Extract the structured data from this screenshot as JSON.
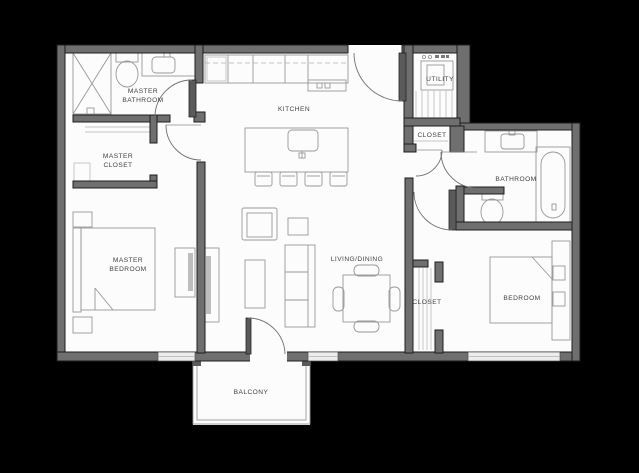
{
  "title": "two-bedroom-apartment-floor-plan",
  "colors": {
    "background": "#000000",
    "floor": "#fcfcfc",
    "wall_fill": "#6f6f6f",
    "wall_edge": "#1e1e1e",
    "furniture_line": "#989898",
    "window_fill": "#ededed",
    "label_text": "#3f3f3f"
  },
  "rooms": [
    {
      "id": "master-bathroom",
      "label_line1": "MASTER",
      "label_line2": "BATHROOM"
    },
    {
      "id": "master-closet",
      "label_line1": "MASTER",
      "label_line2": "CLOSET"
    },
    {
      "id": "kitchen",
      "label": "KITCHEN"
    },
    {
      "id": "utility",
      "label": "UTILITY"
    },
    {
      "id": "entry-closet",
      "label": "CLOSET"
    },
    {
      "id": "bathroom",
      "label": "BATHROOM"
    },
    {
      "id": "master-bedroom",
      "label_line1": "MASTER",
      "label_line2": "BEDROOM"
    },
    {
      "id": "living-dining",
      "label": "LIVING/DINING"
    },
    {
      "id": "bedroom-closet",
      "label": "CLOSET"
    },
    {
      "id": "bedroom",
      "label": "BEDROOM"
    },
    {
      "id": "balcony",
      "label": "BALCONY"
    }
  ],
  "fixtures": [
    "shower",
    "toilet",
    "vanity-sink",
    "kitchen-counter",
    "kitchen-island",
    "bar-stools",
    "washer-dryer",
    "bathtub",
    "sofa",
    "armchair",
    "coffee-table",
    "tv-console",
    "dresser",
    "dining-table",
    "bed",
    "nightstand",
    "balcony-railing",
    "door-swing",
    "window",
    "closet-rod"
  ]
}
